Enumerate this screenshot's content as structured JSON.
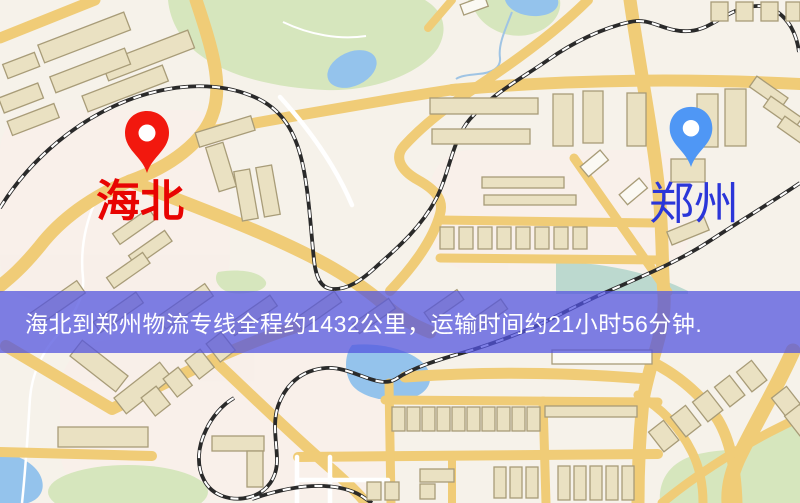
{
  "map": {
    "banner": {
      "text": "海北到郑州物流专线全程约1432公里，运输时间约21小时56分钟.",
      "bg_style": "background-color: rgba(82,84,223,0.74);",
      "text_color": "#ffffff"
    },
    "markers": {
      "origin": {
        "label": "海北",
        "pin_color": "#f2180e",
        "label_color": "#e80402"
      },
      "destination": {
        "label": "郑州",
        "pin_color": "#4f97f5",
        "label_color": "#2b36d9"
      }
    },
    "route": {
      "distance_text": "约1432公里",
      "duration_text": "约21小时56分钟"
    },
    "colors": {
      "background": "#f6f2ea",
      "patch_pink": "#f9efe9",
      "road": "#f0cc77",
      "road_minor": "#ffffff",
      "building_fill": "#eae1c2",
      "building_stroke": "#a89c78",
      "building_white": "#fbf9f3",
      "park": "#d6e6bd",
      "park_teal": "#bcd9cf",
      "water": "#94c3ec",
      "stream": "#9fc4e4",
      "railway": "#2a2a2a"
    }
  }
}
